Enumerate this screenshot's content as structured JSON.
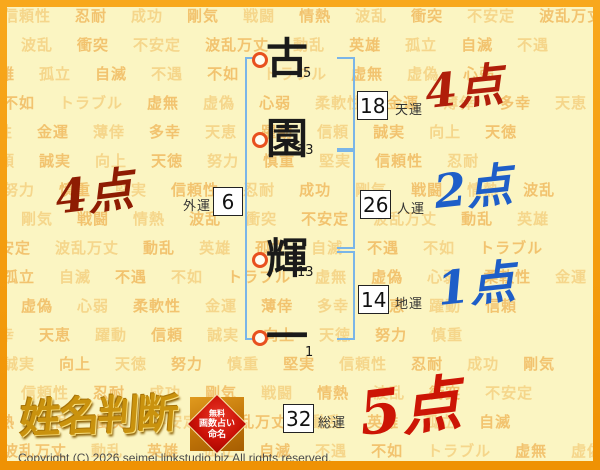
{
  "page": {
    "bg_color": "#fbf5c2",
    "frame_color": "#f49c0e",
    "bracket_color": "#7ab5e8",
    "marker_ring_color": "#e8511f",
    "score_red_dark": "#8e1c02",
    "score_red": "#b01e0a",
    "score_blue": "#1e5ec8",
    "score_big_red": "#cc1505",
    "logo_gold": "#c9920e"
  },
  "name": {
    "characters": [
      {
        "char": "古",
        "strokes": "5"
      },
      {
        "char": "園",
        "strokes": "13"
      },
      {
        "char": "輝",
        "strokes": "13"
      },
      {
        "char": "一",
        "strokes": "1"
      }
    ]
  },
  "fortunes": [
    {
      "label": "天運",
      "value": "18",
      "score": "4点"
    },
    {
      "label": "人運",
      "value": "26",
      "score": "2点"
    },
    {
      "label": "地運",
      "value": "14",
      "score": "1点"
    },
    {
      "label": "外運",
      "value": "6",
      "score": "4点"
    },
    {
      "label": "総運",
      "value": "32",
      "score": "5点"
    }
  ],
  "watermark": {
    "words": [
      "信頼性",
      "忍耐",
      "成功",
      "剛気",
      "戦闘",
      "情熱",
      "波乱",
      "衝突",
      "不安定",
      "波乱万丈",
      "動乱",
      "英雄",
      "孤立",
      "自滅",
      "不遇",
      "不如",
      "トラブル",
      "虚無",
      "虚偽",
      "心弱",
      "柔軟性",
      "金運",
      "薄倖",
      "多幸",
      "天恵",
      "躍動",
      "信頼",
      "誠実",
      "向上",
      "天徳",
      "努力",
      "慎重",
      "堅実"
    ]
  },
  "logo": {
    "title": "姓名判断"
  },
  "badge": {
    "lines": [
      "無料",
      "画数占い",
      "命名"
    ]
  },
  "footer": {
    "copyright": "Copyright (C) 2026 seimei.linkstudio.biz All rights reserved."
  }
}
